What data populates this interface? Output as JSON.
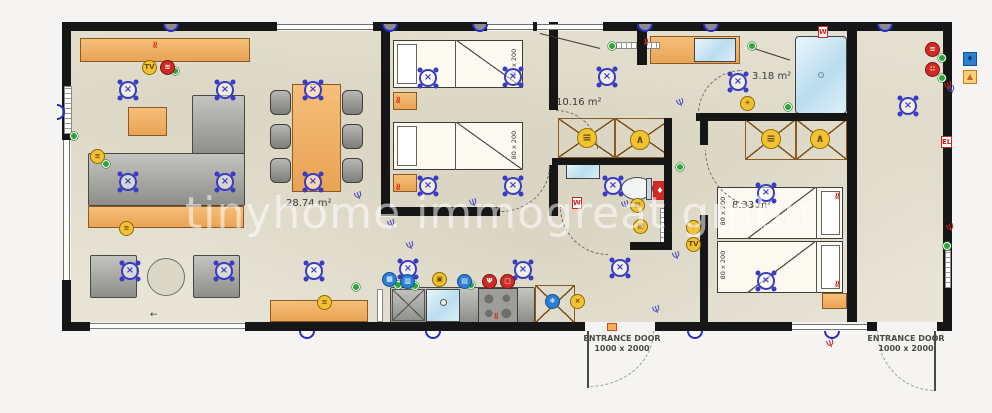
{
  "watermark": "tinyhome immogreat gmbh",
  "labels": {
    "living_area": "28.74 m²",
    "hall_area": "10.16 m²",
    "bath_area": "3.18 m²",
    "bedroom2_area": "8.33 m²",
    "bed_size": "80 x 200",
    "entrance_line1": "ENTRANCE DOOR",
    "entrance_line2": "1000 x 2000",
    "washer": "W",
    "electrical": "EL"
  },
  "colors": {
    "wall": "#161616",
    "floor": "#e8e4d6",
    "wood": "#eeae5f",
    "light_symbol": "#3b3bc2",
    "accent_yellow": "#f2c233",
    "accent_red": "#cf2b24",
    "accent_blue": "#2d7fd3",
    "accent_green": "#2fa33c",
    "water_blue": "#c3e1f0"
  },
  "symbols": {
    "ceiling_lights": [
      [
        128,
        90
      ],
      [
        225,
        90
      ],
      [
        313,
        90
      ],
      [
        128,
        182
      ],
      [
        225,
        182
      ],
      [
        313,
        182
      ],
      [
        130,
        271
      ],
      [
        224,
        271
      ],
      [
        314,
        271
      ],
      [
        428,
        78
      ],
      [
        513,
        77
      ],
      [
        428,
        186
      ],
      [
        513,
        186
      ],
      [
        408,
        269
      ],
      [
        523,
        270
      ],
      [
        607,
        77
      ],
      [
        613,
        186
      ],
      [
        620,
        268
      ],
      [
        738,
        82
      ],
      [
        766,
        193
      ],
      [
        766,
        281
      ],
      [
        908,
        106
      ]
    ],
    "wall_lights_top": [
      171,
      390,
      480,
      645,
      711,
      885
    ],
    "wall_lights_bottom": [
      307,
      433,
      695,
      832
    ],
    "wall_lights_left": [
      [
        57,
        112
      ]
    ],
    "sockets_blue": [
      [
        360,
        198
      ],
      [
        475,
        205
      ],
      [
        627,
        207
      ],
      [
        678,
        258
      ],
      [
        682,
        105
      ],
      [
        953,
        92
      ],
      [
        393,
        226
      ],
      [
        412,
        248
      ],
      [
        658,
        312
      ]
    ],
    "sockets_red": [
      [
        832,
        346
      ],
      [
        952,
        230
      ],
      [
        950,
        88
      ]
    ],
    "heaters_red": [
      [
        399,
        100
      ],
      [
        399,
        187
      ],
      [
        838,
        196
      ],
      [
        838,
        284
      ],
      [
        647,
        42
      ],
      [
        497,
        316
      ],
      [
        156,
        45
      ]
    ],
    "green_dots": [
      [
        175,
        71
      ],
      [
        106,
        164
      ],
      [
        74,
        136
      ],
      [
        356,
        287
      ],
      [
        398,
        285
      ],
      [
        415,
        286
      ],
      [
        471,
        285
      ],
      [
        612,
        46
      ],
      [
        752,
        46
      ],
      [
        788,
        107
      ],
      [
        947,
        246
      ],
      [
        680,
        167
      ],
      [
        942,
        58
      ],
      [
        942,
        78
      ]
    ],
    "yellow_badges": [
      [
        150,
        68,
        "TV"
      ],
      [
        98,
        157,
        "≡"
      ],
      [
        127,
        229,
        "≡"
      ],
      [
        325,
        303,
        "≡"
      ],
      [
        440,
        280,
        "▣"
      ],
      [
        578,
        302,
        "×"
      ],
      [
        748,
        104,
        "☀"
      ],
      [
        638,
        206,
        "▤"
      ],
      [
        641,
        227,
        "▣"
      ],
      [
        694,
        228,
        "☼"
      ],
      [
        694,
        245,
        "TV"
      ]
    ],
    "red_badges": [
      [
        168,
        68,
        "≋"
      ],
      [
        490,
        282,
        "Ψ"
      ],
      [
        508,
        282,
        "▢"
      ],
      [
        933,
        50,
        "≡"
      ],
      [
        933,
        70,
        "∷"
      ]
    ],
    "blue_badges": [
      [
        390,
        280,
        "▦"
      ],
      [
        408,
        282,
        "▥"
      ],
      [
        465,
        282,
        "▤"
      ],
      [
        553,
        302,
        "❄"
      ]
    ],
    "wardrobe_icons": [
      [
        587,
        138,
        "≡"
      ],
      [
        640,
        140,
        "∧"
      ],
      [
        771,
        139,
        "≡"
      ],
      [
        820,
        139,
        "∧"
      ]
    ],
    "washer_boxes": [
      [
        818,
        26
      ],
      [
        572,
        197
      ]
    ],
    "electrical_boxes": [
      [
        941,
        136
      ]
    ],
    "utility_water_box": [
      963,
      52
    ],
    "utility_heat_box": [
      963,
      70
    ]
  }
}
